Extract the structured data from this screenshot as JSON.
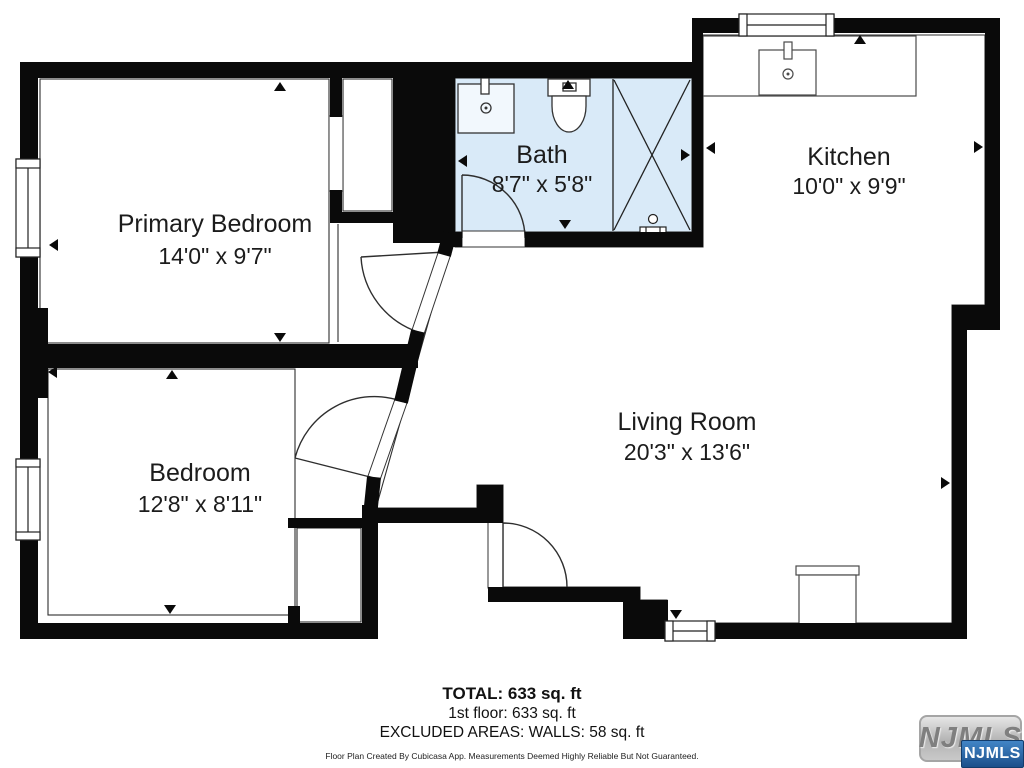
{
  "floor_plan": {
    "rooms": [
      {
        "name": "Primary Bedroom",
        "dimensions": "14'0\" x 9'7\""
      },
      {
        "name": "Bedroom",
        "dimensions": "12'8\" x 8'11\""
      },
      {
        "name": "Bath",
        "dimensions": "8'7\" x 5'8\""
      },
      {
        "name": "Kitchen",
        "dimensions": "10'0\" x 9'9\""
      },
      {
        "name": "Living Room",
        "dimensions": "20'3\" x 13'6\""
      }
    ],
    "summary": {
      "total": "TOTAL: 633 sq. ft",
      "floor": "1st floor: 633 sq. ft",
      "excluded": "EXCLUDED AREAS: WALLS: 58 sq. ft"
    },
    "disclaimer": "Floor Plan Created By Cubicasa App. Measurements Deemed Highly Reliable But Not Guaranteed.",
    "watermark": {
      "label": "NJMLS"
    },
    "colors": {
      "wall": "#0a0a0a",
      "bath_fill": "#d9eaf8",
      "line": "#2f2f2f",
      "watermark_blue": "#2a6cb0",
      "watermark_gray": "#bdbdbd"
    }
  }
}
